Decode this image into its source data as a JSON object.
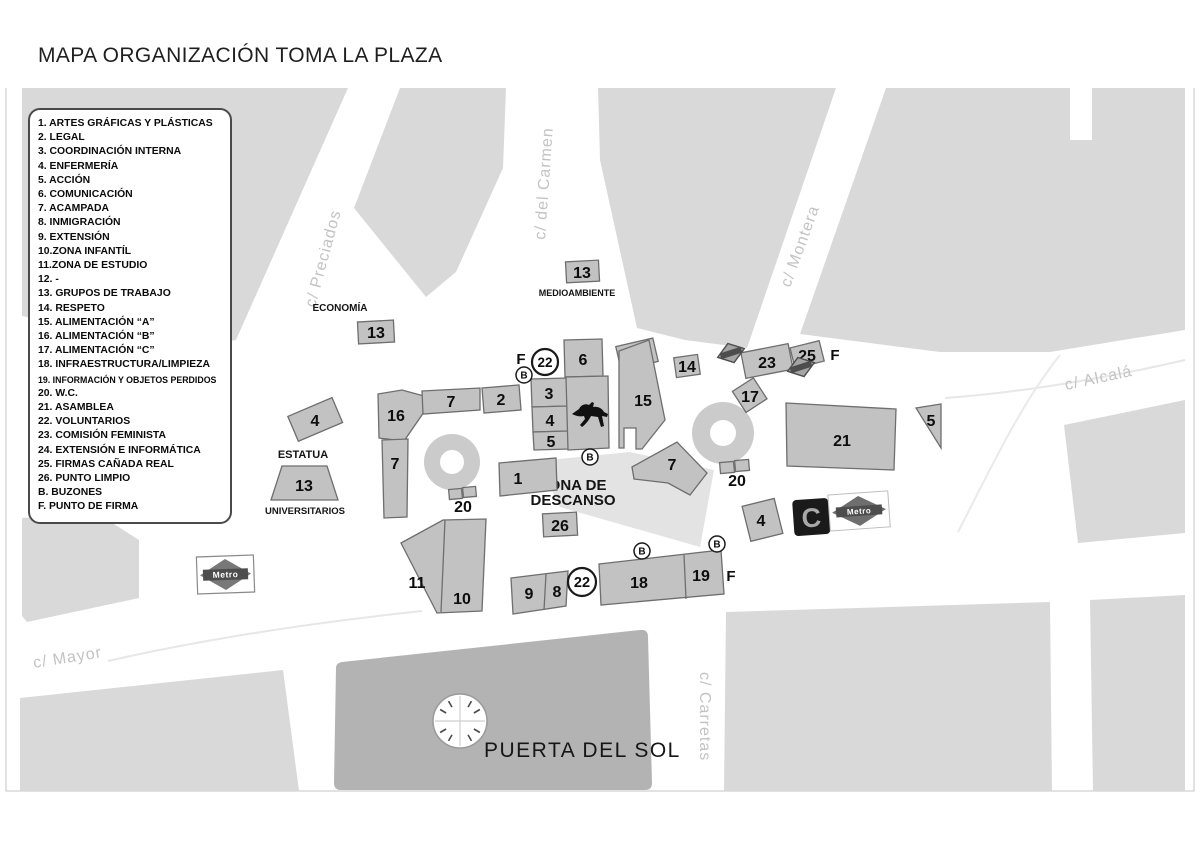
{
  "title": "MAPA ORGANIZACIÓN TOMA LA PLAZA",
  "legend": {
    "items": [
      "1. ARTES GRÁFICAS Y PLÁSTICAS",
      "2. LEGAL",
      "3. COORDINACIÓN  INTERNA",
      "4. ENFERMERÍA",
      "5. ACCIÓN",
      "6. COMUNICACIÓN",
      "7. ACAMPADA",
      "8. INMIGRACIÓN",
      "9. EXTENSIÓN",
      "10.ZONA INFANTÍL",
      "11.ZONA DE ESTUDIO",
      "12. -",
      "13. GRUPOS DE TRABAJO",
      "14. RESPETO",
      "15. ALIMENTACIÓN “A”",
      "16. ALIMENTACIÓN “B”",
      "17. ALIMENTACIÓN “C”",
      "18. INFRAESTRUCTURA/LIMPIEZA",
      "19. INFORMACIÓN Y OBJETOS PERDIDOS",
      "20. W.C.",
      "21. ASAMBLEA",
      "22. VOLUNTARIOS",
      "23. COMISIÓN FEMINISTA",
      "24. EXTENSIÓN E INFORMÁTICA",
      "25. FIRMAS CAÑADA REAL",
      "26. PUNTO LIMPIO",
      "B. BUZONES",
      "F. PUNTO DE FIRMA"
    ]
  },
  "streets": {
    "preciados": "c/ Preciados",
    "carmen": "c/ del Carmen",
    "montera": "c/ Montera",
    "alcala": "c/ Alcalá",
    "mayor": "c/ Mayor",
    "carretas": "c/ Carretas"
  },
  "labels": {
    "economia": "ECONOMÍA",
    "medioambiente": "MEDIOAMBIENTE",
    "estatua": "ESTATUA",
    "universitarios": "UNIVERSITARIOS",
    "zona_descanso_1": "ZONA DE",
    "zona_descanso_2": "DESCANSO",
    "puerta_del_sol": "PUERTA DEL SOL"
  },
  "stands": {
    "economia": "13",
    "medioambiente": "13",
    "oeste4": "4",
    "universitarios": "13",
    "n16": "16",
    "norte7": "7",
    "n2": "2",
    "n3": "3",
    "c4": "4",
    "c5": "5",
    "n6": "6",
    "n24": "24",
    "n15": "15",
    "n14": "14",
    "n23": "23",
    "n25": "25",
    "n17": "17",
    "n21": "21",
    "tri5": "5",
    "vert7": "7",
    "este7": "7",
    "n1": "1",
    "n26": "26",
    "este4": "4",
    "n11": "11",
    "n10": "10",
    "n9": "9",
    "n8": "8",
    "n18": "18",
    "n19": "19",
    "wc_oeste": "20",
    "wc_este": "20"
  },
  "markers": {
    "b": "B",
    "f": "F",
    "voluntarios": "22"
  },
  "logos": {
    "metro": "Metro",
    "cercanias": "C"
  },
  "colors": {
    "building_block": "#d9d9d9",
    "stand_fill": "#c2c2c2",
    "stand_stroke": "#6e6e6e",
    "puerta_del_sol_building": "#b3b3b3",
    "descanso_zone": "#e3e3e3",
    "street_text": "#c3c3c3",
    "ink": "#0d0d0d"
  }
}
